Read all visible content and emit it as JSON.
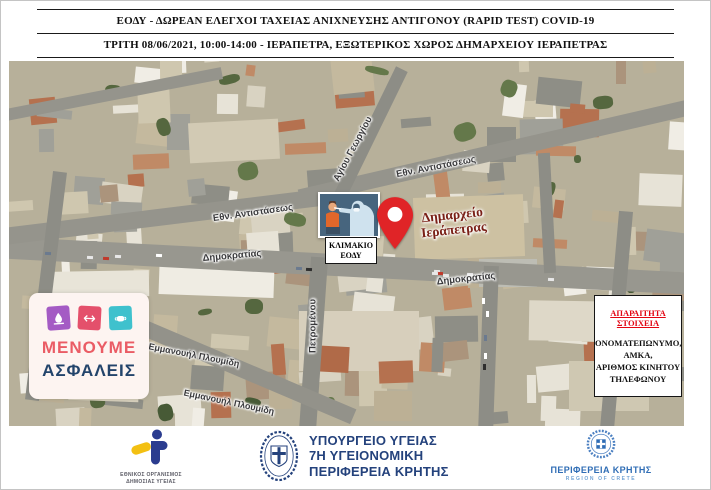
{
  "header": {
    "line1": "ΕΟΔΥ - ΔΩΡΕΑΝ ΕΛΕΓΧΟΙ ΤΑΧΕΙΑΣ ΑΝΙΧΝΕΥΣΗΣ ΑΝΤΙΓΟΝΟΥ (RAPID TEST) COVID-19",
    "line2": "ΤΡΙΤΗ 08/06/2021, 10:00-14:00 - ΙΕΡΑΠΕΤΡΑ, ΕΞΩΤΕΡΙΚΟΣ ΧΩΡΟΣ ΔΗΜΑΡΧΕΙΟΥ ΙΕΡΑΠΕΤΡΑΣ"
  },
  "map": {
    "street_labels": [
      "Αγίου Γεωργίου",
      "Εθν. Αντιστάσεως",
      "Εθν. Αντιστάσεως",
      "Δημοκρατίας",
      "Δημοκρατίας",
      "Πετρομένου",
      "Εμμανουήλ Πλουμίδη",
      "Εμμανουήλ Πλουμίδη"
    ],
    "eody_team_box": {
      "line1": "ΚΛΙΜΑΚΙΟ",
      "line2": "ΕΟΔΥ"
    },
    "pin_label": {
      "line1": "Δημαρχείο",
      "line2": "Ιεράπετρας"
    },
    "stay_safe_badge": {
      "line1": "ΜΕΝΟΥΜΕ",
      "line2": "ΑΣΦΑΛΕΙΣ",
      "icons": [
        "handwash-icon",
        "distance-icon",
        "mask-icon"
      ]
    },
    "required_info_box": {
      "title": "ΑΠΑΡΑΙΤΗΤΑ ΣΤΟΙΧΕΙΑ",
      "lines": [
        "ΟΝΟΜΑΤΕΠΩΝΥΜΟ,",
        "ΑΜΚΑ,",
        "ΑΡΙΘΜΟΣ ΚΙΝΗΤΟΥ",
        "ΤΗΛΕΦΩΝΟΥ"
      ]
    }
  },
  "footer": {
    "eody_logo": {
      "line1": "ΕΘΝΙΚΟΣ ΟΡΓΑΝΙΣΜΟΣ",
      "line2": "ΔΗΜΟΣΙΑΣ ΥΓΕΙΑΣ"
    },
    "ministry_logo": {
      "line1": "ΥΠΟΥΡΓΕΙΟ ΥΓΕΙΑΣ",
      "line2": "7Η ΥΓΕΙΟΝΟΜΙΚΗ",
      "line3": "ΠΕΡΙΦΕΡΕΙΑ ΚΡΗΤΗΣ"
    },
    "crete_logo": {
      "line1": "ΠΕΡΙΦΕΡΕΙΑ ΚΡΗΤΗΣ",
      "line2": "REGION OF CRETE"
    }
  },
  "colors": {
    "pin-red": "#e02427",
    "info-title-red": "#e30613",
    "stay-safe-pink": "#ea5c65",
    "stay-safe-navy": "#23446b",
    "icon-purple": "#a45bc4",
    "icon-red": "#e4506b",
    "icon-teal": "#3fc1cd",
    "ministry-blue": "#24427c",
    "crete-blue": "#2f6db5",
    "crete-light-blue": "#74a5d6",
    "eody-blue": "#2b3c8f",
    "eody-yellow": "#f3c012",
    "pin-label-maroon": "#7a2017"
  }
}
